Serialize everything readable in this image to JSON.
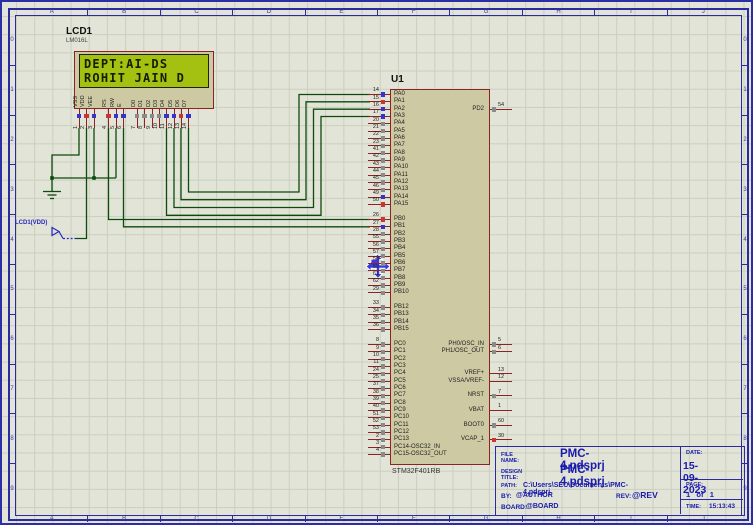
{
  "sheet": {
    "ruler_letters": [
      "A",
      "B",
      "C",
      "D",
      "E",
      "F",
      "G",
      "H",
      "I",
      "J"
    ],
    "ruler_numbers": [
      "0",
      "1",
      "2",
      "3",
      "4",
      "5",
      "6",
      "7",
      "8",
      "9"
    ]
  },
  "lcd": {
    "ref": "LCD1",
    "model": "LM016L",
    "screen_line1": "DEPT:AI-DS",
    "screen_line2": "ROHIT JAIN D",
    "pins": [
      {
        "num": "1",
        "name": "VSS",
        "state": "low"
      },
      {
        "num": "2",
        "name": "VDD",
        "state": "high"
      },
      {
        "num": "3",
        "name": "VEE",
        "state": "low"
      },
      {
        "num": "4",
        "name": "RS",
        "state": "high"
      },
      {
        "num": "5",
        "name": "RW",
        "state": "low"
      },
      {
        "num": "6",
        "name": "E",
        "state": "low"
      },
      {
        "num": "7",
        "name": "D0",
        "state": "float"
      },
      {
        "num": "8",
        "name": "D1",
        "state": "float"
      },
      {
        "num": "9",
        "name": "D2",
        "state": "float"
      },
      {
        "num": "10",
        "name": "D3",
        "state": "float"
      },
      {
        "num": "11",
        "name": "D4",
        "state": "low"
      },
      {
        "num": "12",
        "name": "D5",
        "state": "low"
      },
      {
        "num": "13",
        "name": "D6",
        "state": "high"
      },
      {
        "num": "14",
        "name": "D7",
        "state": "low"
      }
    ]
  },
  "power_terminal": {
    "label": "LCD1(VDD)"
  },
  "mcu": {
    "ref": "U1",
    "part": "STM32F401RB",
    "left_groups": [
      {
        "pins": [
          {
            "num": "14",
            "name": "PA0",
            "state": "low"
          },
          {
            "num": "15",
            "name": "PA1",
            "state": "high"
          },
          {
            "num": "16",
            "name": "PA2",
            "state": "low"
          },
          {
            "num": "17",
            "name": "PA3",
            "state": "low"
          },
          {
            "num": "20",
            "name": "PA4",
            "state": "float"
          },
          {
            "num": "21",
            "name": "PA5",
            "state": "float"
          },
          {
            "num": "22",
            "name": "PA6",
            "state": "float"
          },
          {
            "num": "23",
            "name": "PA7",
            "state": "float"
          },
          {
            "num": "41",
            "name": "PA8",
            "state": "float"
          },
          {
            "num": "42",
            "name": "PA9",
            "state": "float"
          },
          {
            "num": "43",
            "name": "PA10",
            "state": "float"
          },
          {
            "num": "44",
            "name": "PA11",
            "state": "float"
          },
          {
            "num": "45",
            "name": "PA12",
            "state": "float"
          },
          {
            "num": "46",
            "name": "PA13",
            "state": "float"
          },
          {
            "num": "49",
            "name": "PA14",
            "state": "low"
          },
          {
            "num": "50",
            "name": "PA15",
            "state": "high"
          }
        ]
      },
      {
        "pins": [
          {
            "num": "26",
            "name": "PB0",
            "state": "high"
          },
          {
            "num": "27",
            "name": "PB1",
            "state": "low"
          },
          {
            "num": "28",
            "name": "PB2",
            "state": "float"
          },
          {
            "num": "55",
            "name": "PB3",
            "state": "float"
          },
          {
            "num": "56",
            "name": "PB4",
            "state": "float"
          },
          {
            "num": "57",
            "name": "PB5",
            "state": "float"
          },
          {
            "num": "58",
            "name": "PB6",
            "state": "float"
          },
          {
            "num": "59",
            "name": "PB7",
            "state": "float"
          },
          {
            "num": "61",
            "name": "PB8",
            "state": "float"
          },
          {
            "num": "62",
            "name": "PB9",
            "state": "float"
          },
          {
            "num": "29",
            "name": "PB10",
            "state": "float"
          },
          null,
          {
            "num": "33",
            "name": "PB12",
            "state": "float"
          },
          {
            "num": "34",
            "name": "PB13",
            "state": "float"
          },
          {
            "num": "35",
            "name": "PB14",
            "state": "float"
          },
          {
            "num": "36",
            "name": "PB15",
            "state": "float"
          }
        ]
      },
      {
        "pins": [
          {
            "num": "8",
            "name": "PC0",
            "state": "float"
          },
          {
            "num": "9",
            "name": "PC1",
            "state": "float"
          },
          {
            "num": "10",
            "name": "PC2",
            "state": "float"
          },
          {
            "num": "11",
            "name": "PC3",
            "state": "float"
          },
          {
            "num": "24",
            "name": "PC4",
            "state": "float"
          },
          {
            "num": "25",
            "name": "PC5",
            "state": "float"
          },
          {
            "num": "37",
            "name": "PC6",
            "state": "float"
          },
          {
            "num": "38",
            "name": "PC7",
            "state": "float"
          },
          {
            "num": "39",
            "name": "PC8",
            "state": "float"
          },
          {
            "num": "40",
            "name": "PC9",
            "state": "float"
          },
          {
            "num": "51",
            "name": "PC10",
            "state": "float"
          },
          {
            "num": "52",
            "name": "PC11",
            "state": "float"
          },
          {
            "num": "53",
            "name": "PC12",
            "state": "float"
          },
          {
            "num": "2",
            "name": "PC13",
            "state": "float"
          },
          {
            "num": "3",
            "name": "PC14-OSC32_IN",
            "state": "float"
          },
          {
            "num": "4",
            "name": "PC15-OSC32_OUT",
            "state": "float"
          }
        ]
      }
    ],
    "right_pins": [
      {
        "num": "54",
        "name": "PD2",
        "state": "float"
      },
      {
        "num": "5",
        "name": "PH0/OSC_IN",
        "state": "float"
      },
      {
        "num": "6",
        "name": "PH1/OSC_OUT",
        "state": "float"
      },
      {
        "num": "13",
        "name": "VREF+",
        "state": "none"
      },
      {
        "num": "12",
        "name": "VSSA/VREF-",
        "state": "none"
      },
      {
        "num": "7",
        "name": "NRST",
        "state": "float"
      },
      {
        "num": "1",
        "name": "VBAT",
        "state": "none"
      },
      {
        "num": "60",
        "name": "BOOT0",
        "state": "float"
      },
      {
        "num": "30",
        "name": "VCAP_1",
        "state": "high"
      }
    ]
  },
  "titleblock": {
    "file_label": "FILE NAME:",
    "file_value": "PMC-4.pdsprj",
    "design_label": "DESIGN TITLE:",
    "design_value": "PMC-4.pdsprj",
    "path_label": "PATH:",
    "path_value": "C:\\Users\\SEC\\Documents\\PMC-4.pdsprj",
    "by_label": "BY:",
    "by_value": "@AUTHOR",
    "rev_label": "REV:",
    "rev_value": "@REV",
    "board_label": "BOARD:",
    "board_value": "@BOARD",
    "date_label": "DATE:",
    "date_value": "15-09-2023",
    "page_label": "PAGE:",
    "page_value": "1   of   1",
    "time_label": "TIME:",
    "time_value": "15:13:43"
  },
  "colors": {
    "wire": "#0d4a0d",
    "pin": "#8b2323",
    "state_low": "#3434cc",
    "state_high": "#cc3434",
    "state_float": "#8a8a8a",
    "border_blue": "#2a2aa2",
    "lcd_screen": "#a4c011"
  }
}
